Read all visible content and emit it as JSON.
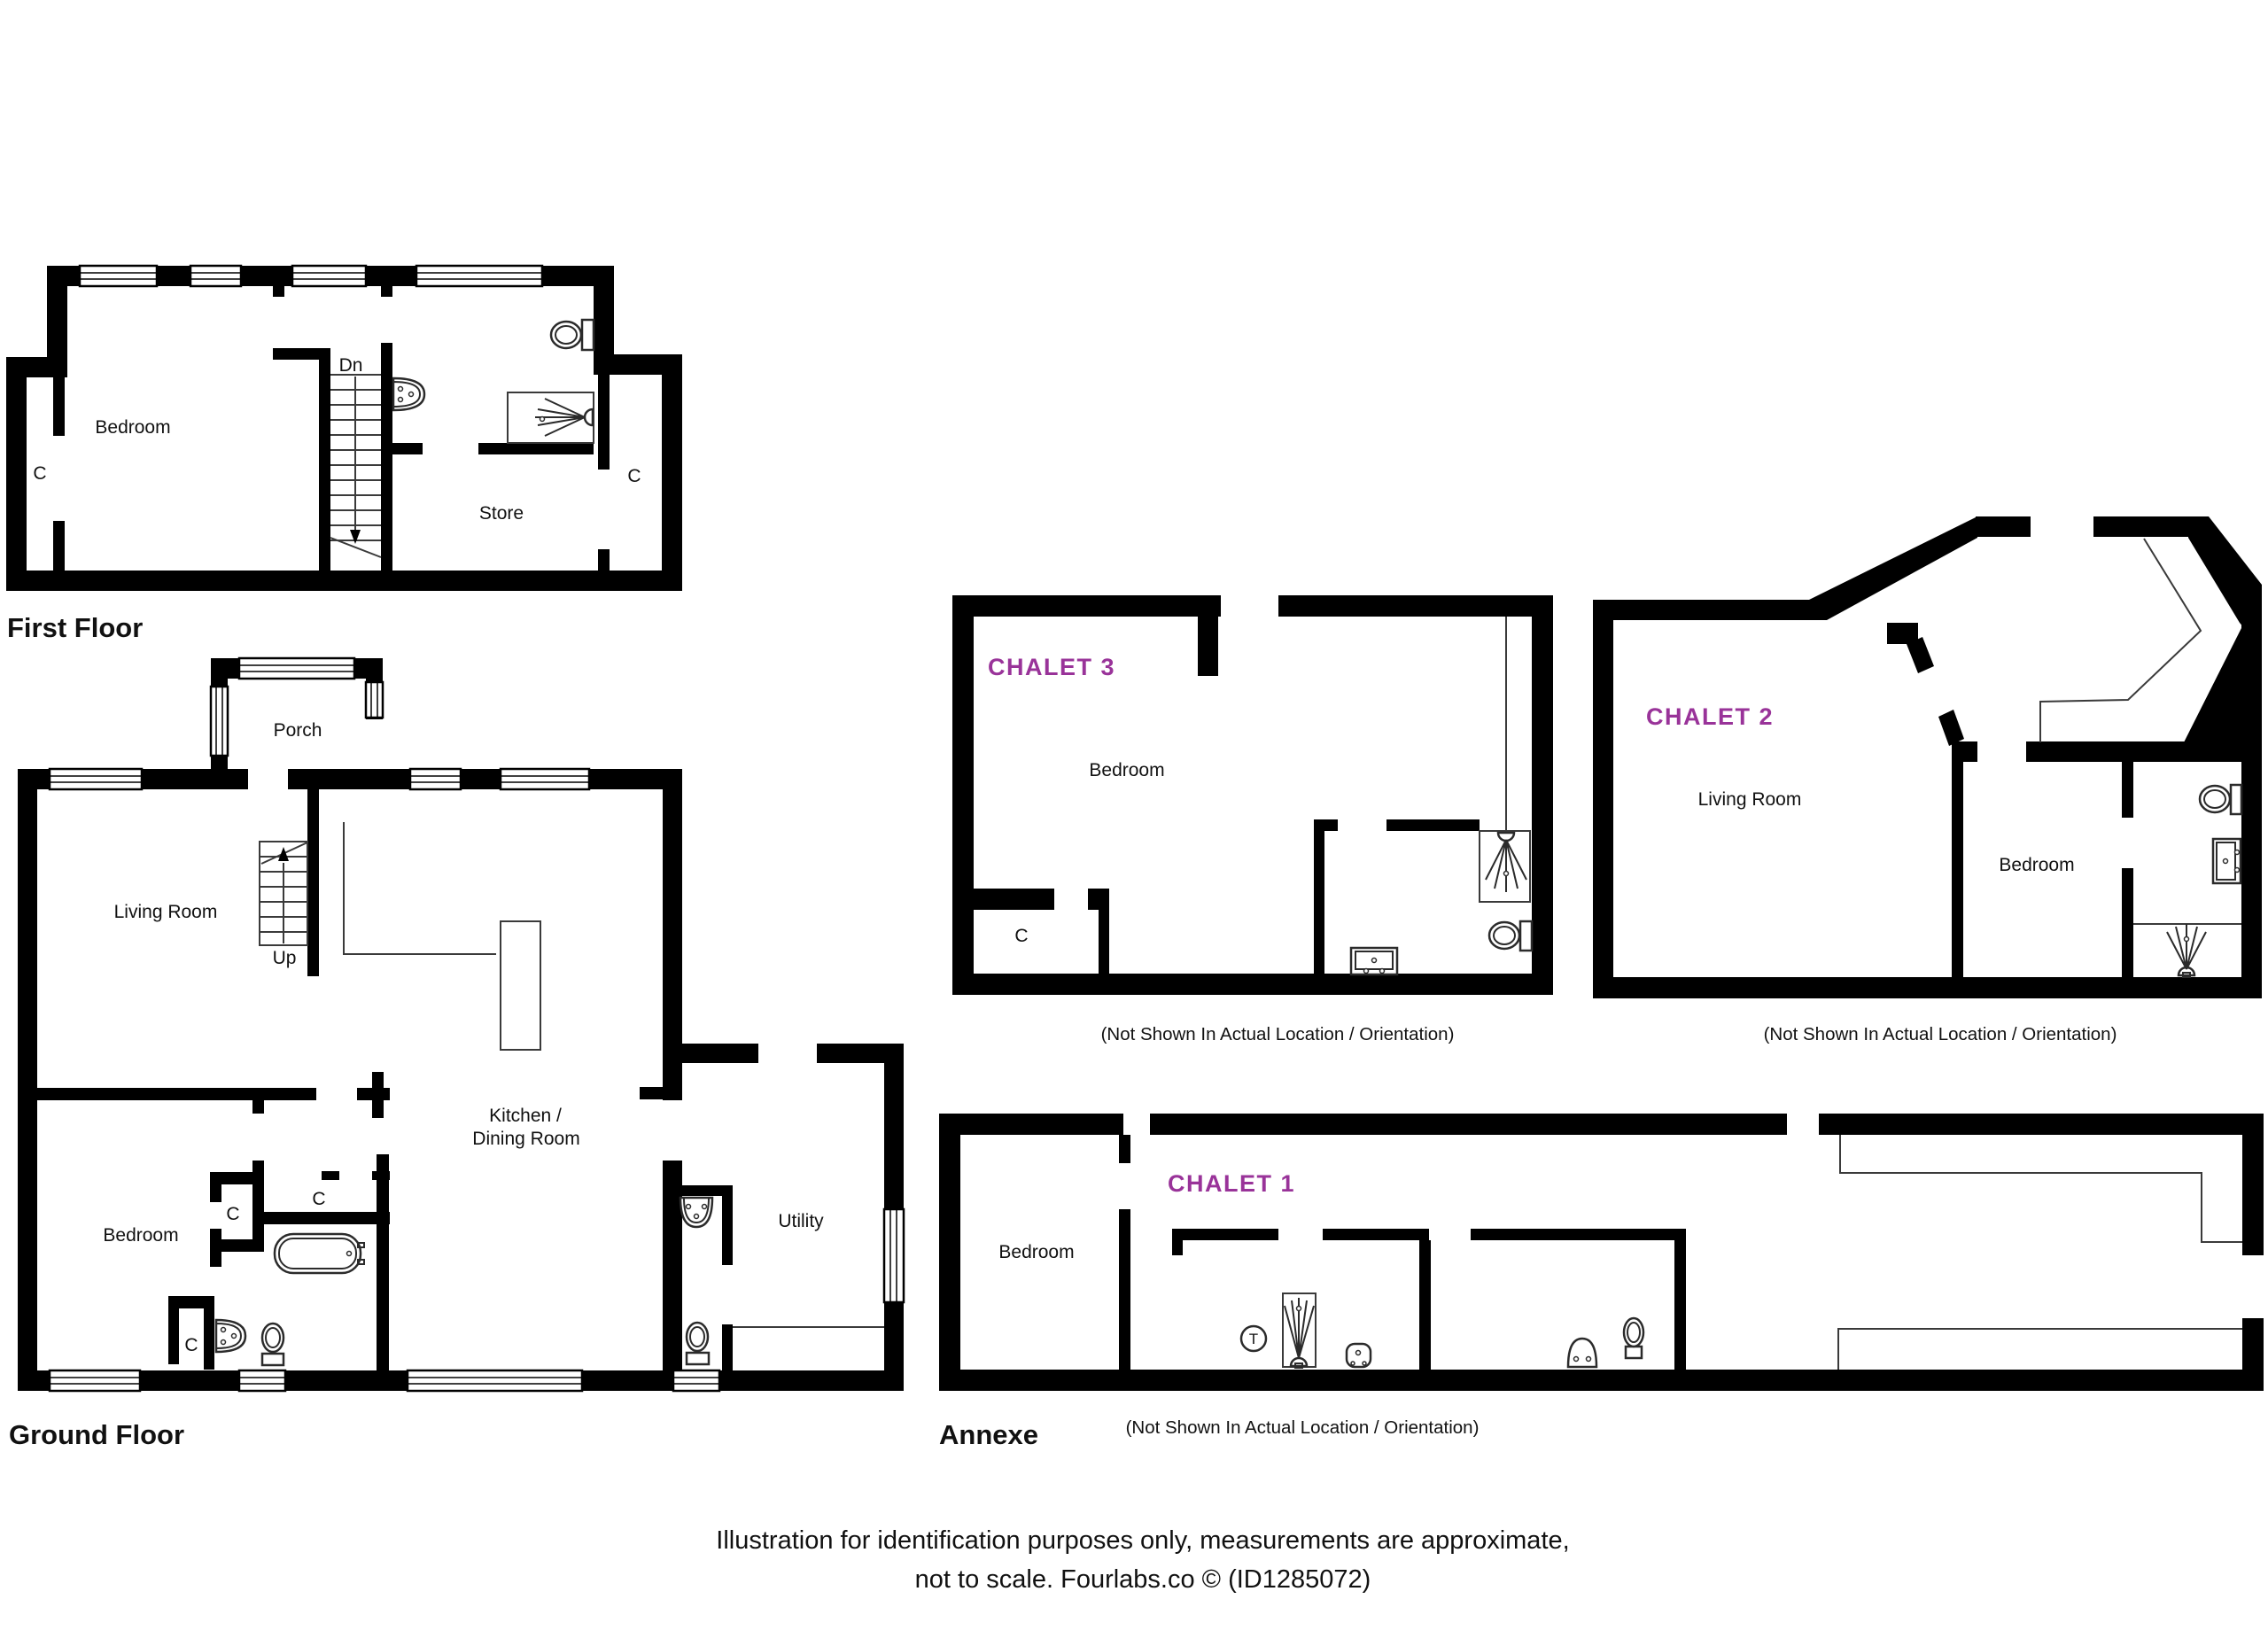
{
  "colors": {
    "wall": "#000000",
    "thin_line": "#3a3a3a",
    "chalet_label": "#993399",
    "text": "#111111",
    "background": "#ffffff"
  },
  "first_floor": {
    "title": "First Floor",
    "bedroom": "Bedroom",
    "store": "Store",
    "closet_left": "C",
    "closet_right": "C",
    "stairs_down": "Dn"
  },
  "ground_floor": {
    "title": "Ground Floor",
    "porch": "Porch",
    "living_room": "Living Room",
    "stairs_up": "Up",
    "kitchen_line1": "Kitchen /",
    "kitchen_line2": "Dining Room",
    "bedroom": "Bedroom",
    "utility": "Utility",
    "closet_hall": "C",
    "closet_inner": "C",
    "closet_bath": "C"
  },
  "chalet3": {
    "label": "CHALET 3",
    "bedroom": "Bedroom",
    "closet": "C",
    "caption": "(Not Shown In Actual Location / Orientation)"
  },
  "chalet2": {
    "label": "CHALET 2",
    "living_room": "Living Room",
    "bedroom": "Bedroom",
    "caption": "(Not Shown In Actual Location / Orientation)"
  },
  "annexe": {
    "title": "Annexe",
    "label": "CHALET 1",
    "bedroom": "Bedroom",
    "tank": "T",
    "caption": "(Not Shown In Actual Location / Orientation)"
  },
  "footer": {
    "line1": "Illustration for identification purposes only, measurements are approximate,",
    "line2": "not to scale. Fourlabs.co © (ID1285072)"
  }
}
